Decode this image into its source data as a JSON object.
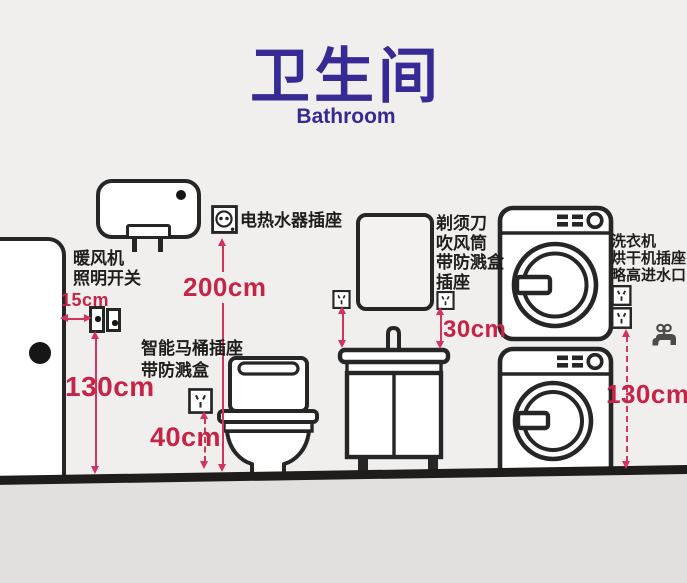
{
  "page": {
    "title_zh": "卫生间",
    "title_en": "Bathroom"
  },
  "colors": {
    "title_purple": "#372a94",
    "label_ink": "#1f1e1d",
    "measure_red": "#c52447",
    "line_pink": "#d0345f",
    "wall_bg": "#f0efee",
    "floor_bg": "#e2e0de",
    "floor_line": "#1f1d1b"
  },
  "annotations": {
    "door_switch": {
      "line1": "暖风机",
      "line2": "照明开关",
      "offset": "15cm",
      "height": "130cm"
    },
    "water_heater": {
      "label": "电热水器插座",
      "height": "200cm"
    },
    "smart_toilet": {
      "line1": "智能马桶插座",
      "line2": "带防溅盒",
      "height": "40cm"
    },
    "vanity": {
      "line1": "剃须刀",
      "line2": "吹风筒",
      "line3": "带防溅盒",
      "line4": "插座",
      "height": "30cm"
    },
    "laundry": {
      "line1": "洗衣机",
      "line2": "烘干机插座",
      "line3": "略高进水口",
      "height": "130cm"
    }
  },
  "icons": {
    "socket_5hole": "chinese five-hole wall socket",
    "socket_round": "round-pin water-heater socket",
    "wall_switch": "single wall switch with indicator dot",
    "faucet": "water tap with inlet valve"
  }
}
